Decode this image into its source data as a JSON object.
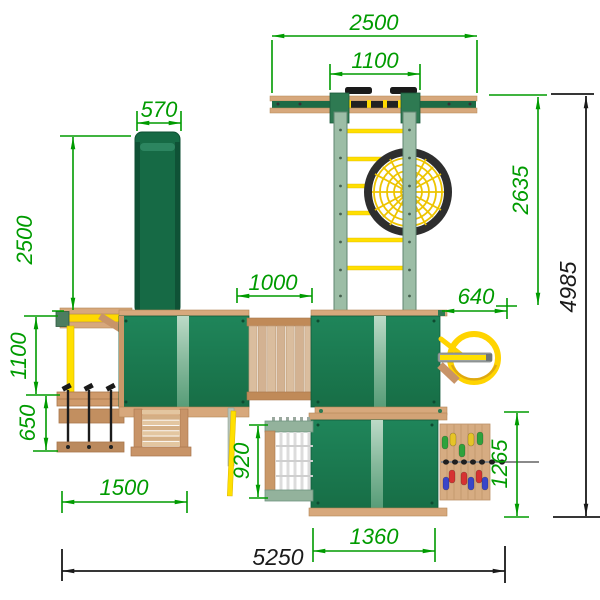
{
  "drawing": {
    "kind": "playground-set-plan-view",
    "units": "mm",
    "dims": {
      "top_beam_length": "2500",
      "top_beam_inner": "1100",
      "slide_width": "570",
      "slide_projection": "2500",
      "swing_bay_depth": "1100",
      "swing_seat_zone": "650",
      "swing_frame_width": "1500",
      "bridge_length": "1000",
      "pole_offset": "640",
      "beam_to_tower": "2635",
      "overall_depth": "4985",
      "net_climber_width": "920",
      "climb_wall_span": "1265",
      "tower_width": "1360",
      "overall_width": "5250"
    },
    "colors": {
      "dimension_green": "#009b00",
      "dimension_black": "#1a1a1a",
      "roof_green": "#1b7c4e",
      "roof_ridge_light": "#b6d6c2",
      "slide_green": "#166a45",
      "wood": "#d7a87c",
      "wood_dark": "#c08a58",
      "accent_yellow": "#ffdf00",
      "rail_sage": "#9cbda6",
      "nest_ring": "#2e2e2e",
      "net_yellow": "#edc400",
      "hold_red": "#d63232",
      "hold_blue": "#3a46c8",
      "hold_green": "#2fa23c",
      "hold_yellow": "#e6c427"
    }
  }
}
